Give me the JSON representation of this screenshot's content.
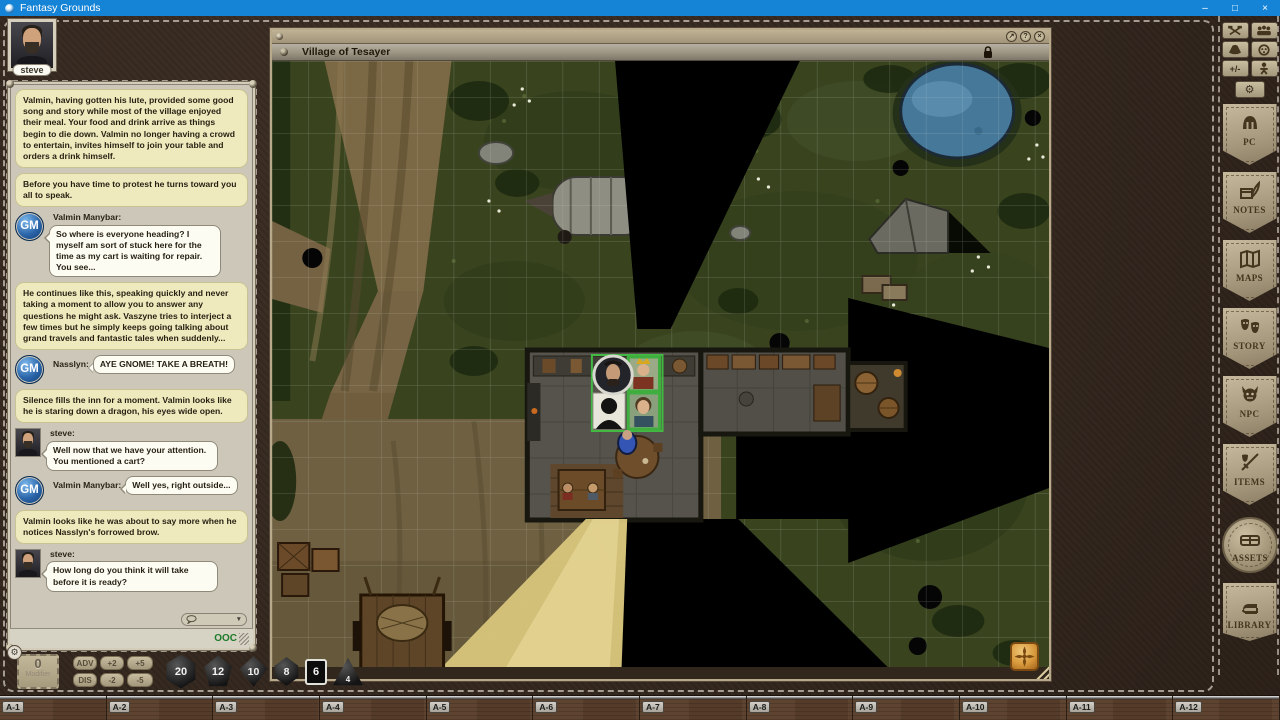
{
  "window": {
    "title": "Fantasy Grounds",
    "controls": {
      "minimize": "–",
      "maximize": "□",
      "close": "×"
    }
  },
  "player": {
    "name": "steve"
  },
  "chat": {
    "gm_label": "GM",
    "ooc_label": "OOC",
    "caret": "▼",
    "messages": [
      {
        "type": "story",
        "text": "Valmin, having gotten his lute, provided some good song and story while most of the village enjoyed their meal. Your food and drink arrive as things begin to die down. Valmin no longer having a crowd to entertain, invites himself to join your table and orders a drink himself."
      },
      {
        "type": "story",
        "text": "Before you have time to protest he turns toward you all to speak."
      },
      {
        "type": "gm",
        "speaker": "Valmin Manybar:",
        "text": "So where is everyone heading? I myself am sort of stuck here for the time as my cart is waiting for repair. You see..."
      },
      {
        "type": "story",
        "text": "He continues like this, speaking quickly and never taking a moment to allow you to answer any questions he might ask. Vaszyne tries to interject a few times but he simply keeps going talking about grand travels and fantastic tales when suddenly..."
      },
      {
        "type": "gm",
        "speaker": "Nasslyn:",
        "text": "AYE GNOME! TAKE A BREATH!"
      },
      {
        "type": "story",
        "text": "Silence fills the inn for a moment. Valmin looks like he is staring down a dragon, his eyes wide open."
      },
      {
        "type": "player",
        "speaker": "steve:",
        "text": "Well now that we have your attention. You mentioned a cart?"
      },
      {
        "type": "gm",
        "speaker": "Valmin Manybar:",
        "text": "Well yes, right outside..."
      },
      {
        "type": "story",
        "text": "Valmin looks like he was about to say more when he notices Nasslyn's forrowed brow."
      },
      {
        "type": "player",
        "speaker": "steve:",
        "text": "How long do you think it will take before it is ready?"
      }
    ]
  },
  "map": {
    "title": "Village of Tesayer",
    "controls": {
      "popout": "↗",
      "help": "?",
      "close": "×"
    }
  },
  "sidebar": {
    "plusminus": "+/-",
    "gear": "⚙",
    "panels": [
      "PC",
      "NOTES",
      "MAPS",
      "STORY",
      "NPC",
      "ITEMS",
      "ASSETS",
      "LIBRARY"
    ]
  },
  "dice_bar": {
    "modifier": {
      "value": "0",
      "label": "Modifier"
    },
    "buttons": {
      "adv": "ADV",
      "dis": "DIS",
      "plus2": "+2",
      "minus2": "-2",
      "plus5": "+5",
      "minus5": "-5"
    },
    "dice": [
      {
        "name": "d20",
        "value": "20"
      },
      {
        "name": "d12",
        "value": "12"
      },
      {
        "name": "d10",
        "value": "10"
      },
      {
        "name": "d8",
        "value": "8"
      },
      {
        "name": "d6",
        "value": "6"
      },
      {
        "name": "d4",
        "value": "4"
      }
    ]
  },
  "hotkeys": [
    "A-1",
    "A-2",
    "A-3",
    "A-4",
    "A-5",
    "A-6",
    "A-7",
    "A-8",
    "A-9",
    "A-10",
    "A-11",
    "A-12"
  ]
}
